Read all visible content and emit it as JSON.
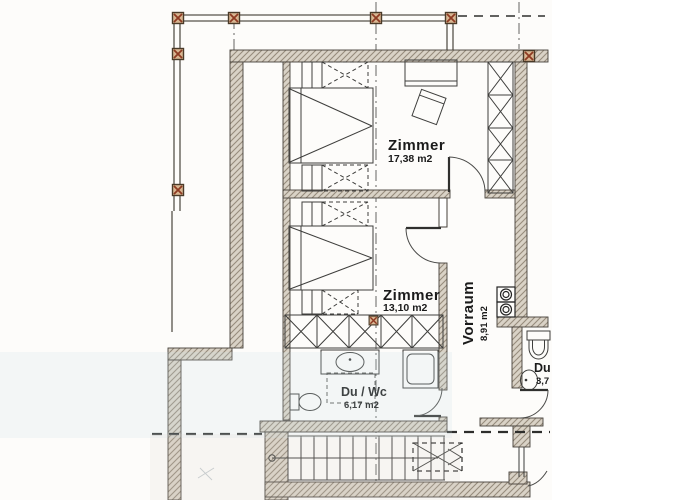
{
  "plan": {
    "type": "floor-plan",
    "rooms": [
      {
        "id": "zimmer-1",
        "name": "Zimmer",
        "area": "17,38 m2"
      },
      {
        "id": "zimmer-2",
        "name": "Zimmer",
        "area": "13,10 m2"
      },
      {
        "id": "vorraum",
        "name": "Vorraum",
        "area": "8,91 m2"
      },
      {
        "id": "du-wc",
        "name": "Du / Wc",
        "area": "6,17 m2"
      },
      {
        "id": "du-right",
        "name": "Du",
        "area": "3,7"
      }
    ],
    "features": [
      "balcony-posts",
      "staircase",
      "wardrobes",
      "beds",
      "shower",
      "toilets",
      "sinks",
      "washer-dryer-stack"
    ],
    "colors": {
      "paper": "#fdfcfa",
      "wall_fill": "#d9d2c6",
      "wall_hatch_line": "#968b7c",
      "line": "#3c3c3a",
      "post_fill": "#d9b692",
      "post_cross": "#8e3a22",
      "scan_tint": "#cfdfe6"
    }
  }
}
